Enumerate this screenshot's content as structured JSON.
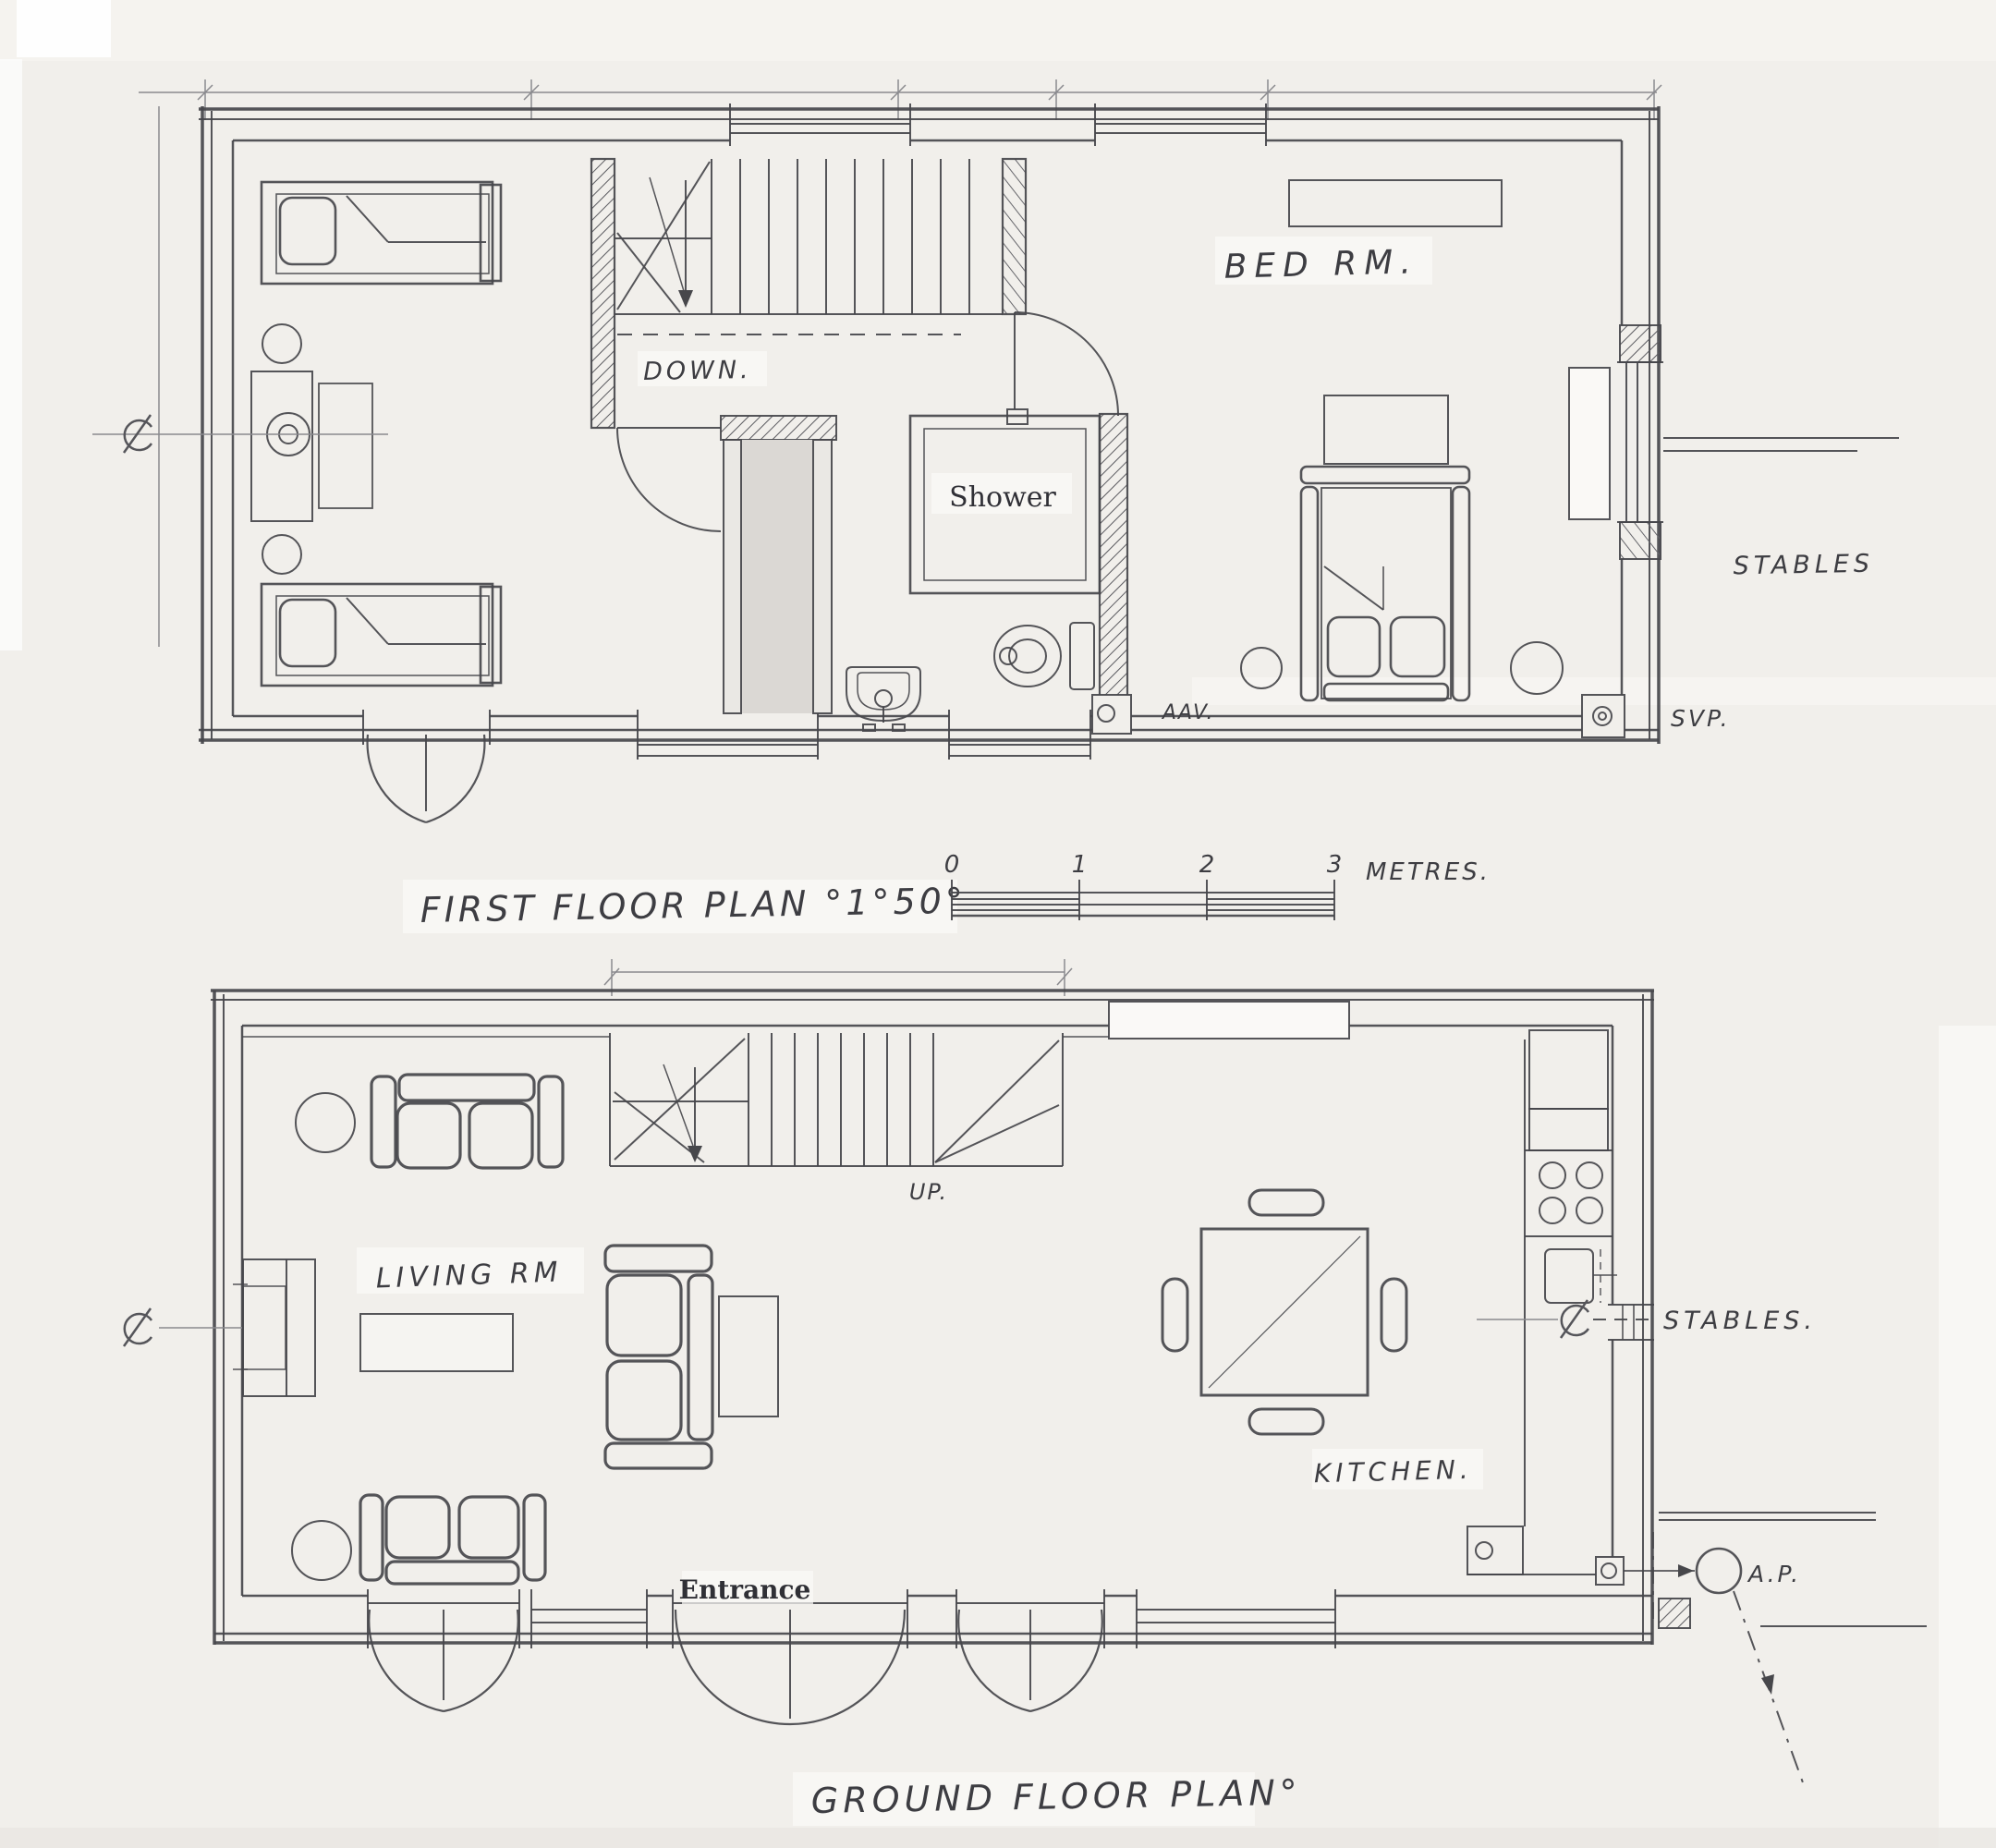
{
  "first_floor": {
    "title": "FIRST FLOOR PLAN °1°50°",
    "labels": {
      "bed_rm": "BED RM.",
      "down": "DOWN.",
      "shower": "Shower",
      "stables": "STABLES",
      "svp": "SVP.",
      "aav": "AAV."
    }
  },
  "scale_bar": {
    "ticks": [
      "0",
      "1",
      "2",
      "3"
    ],
    "unit": "METRES."
  },
  "ground_floor": {
    "title": "GROUND FLOOR PLAN°",
    "labels": {
      "living_rm": "LIVING RM",
      "up": "UP.",
      "kitchen": "KITCHEN.",
      "entrance": "Entrance",
      "stables": "STABLES.",
      "ap": "A.P."
    }
  },
  "colors": {
    "paper": "#f1efeb",
    "ink": "#47474b"
  }
}
